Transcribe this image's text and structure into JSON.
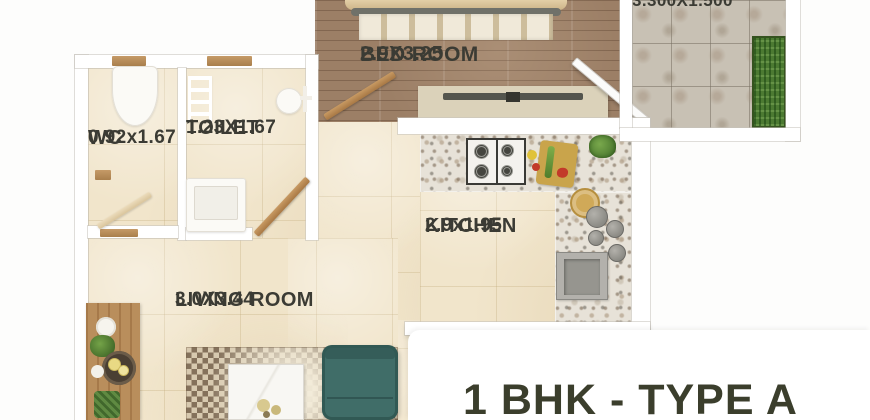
{
  "title": "1 BHK - TYPE A",
  "rooms": {
    "wc": {
      "name": "WC",
      "dims": "0.92x1.67"
    },
    "toilet": {
      "name": "TOILET",
      "dims": "1.23X1.67"
    },
    "bedroom": {
      "name": "BED ROOM",
      "dims": "2.9X3.25"
    },
    "kitchen": {
      "name": "KITCHEN",
      "dims": "2.9x1.95"
    },
    "living_room": {
      "name": "LIVING ROOM",
      "dims": "3.0X3.44"
    },
    "balcony": {
      "dims": "3.300X1.500"
    }
  },
  "colors": {
    "title-color": "#3b3e2c",
    "label-color": "#3b3b34",
    "sofa-teal": "#406d68",
    "wood-floor": "#9c7f66",
    "beige-floor": "#f1e5cb",
    "balcony-tile": "#c8c1b4",
    "planter-green": "#4c7a32",
    "wall-white": "#ffffff"
  }
}
